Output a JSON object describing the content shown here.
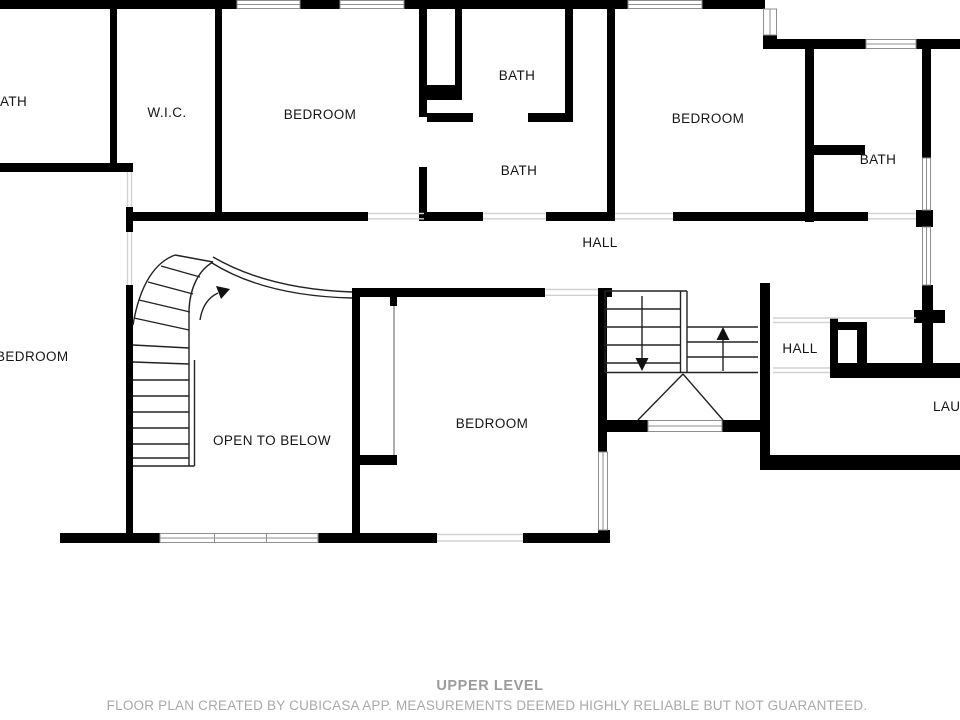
{
  "floor_plan": {
    "labels": {
      "bath_top_left": "ATH",
      "wic": "W.I.C.",
      "bedroom_top_middle": "BEDROOM",
      "bath_upper": "BATH",
      "bath_lower": "BATH",
      "bedroom_top_right": "BEDROOM",
      "bath_right": "BATH",
      "hall_main": "HALL",
      "bedroom_left": "BEDROOM",
      "open_to_below": "OPEN TO BELOW",
      "bedroom_center": "BEDROOM",
      "hall_right": "HALL",
      "laundry": "LAU",
      "stair_up_arrow": "up-direction",
      "stair_down_arrow": "down-direction"
    },
    "footer": {
      "level_title": "UPPER LEVEL",
      "disclaimer": "FLOOR PLAN CREATED BY CUBICASA APP. MEASUREMENTS DEEMED HIGHLY RELIABLE BUT NOT GUARANTEED."
    },
    "colors": {
      "wall": "#000000",
      "room_label": "#161616",
      "window_frame": "#8f8f8f",
      "threshold": "#d2d2d2",
      "footer_title": "#9b9b9b",
      "footer_note": "#a9a9a9",
      "background": "#ffffff"
    }
  }
}
